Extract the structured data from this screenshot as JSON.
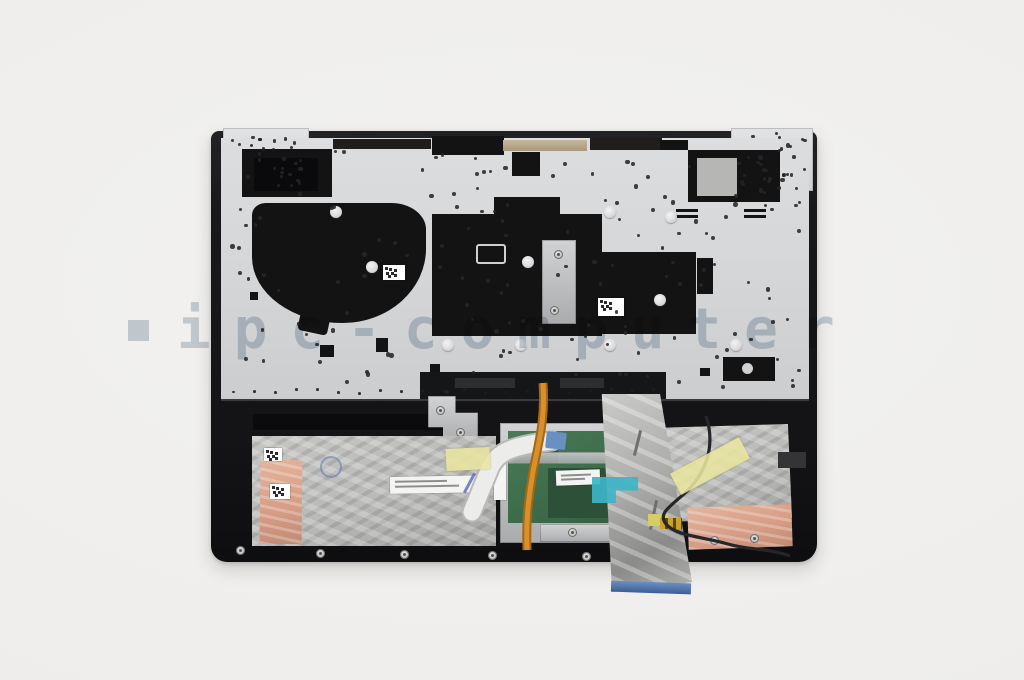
{
  "watermark": {
    "bullet_glyph": "■",
    "text": "ipc-computer",
    "color": "#c7d1d9"
  },
  "photo": {
    "colors": {
      "background": "#f2f1ef",
      "backplate": "#d6d7d9",
      "case": "#19191b",
      "mylar": "#131313",
      "foil": "#b9b9b7",
      "copper_tape": "#d69c85",
      "kapton_tape": "#e9e6a0",
      "touchpad_pcb": "#3c6a49",
      "ffc_ribbon": "#b0b0ae",
      "ribbon_tip": "#6a8fc2",
      "teal_tape": "#3db4c6",
      "backlight_cable": "#d8902f",
      "antenna_wire": "#26262a",
      "touchpad_ffc": "#ececea"
    }
  }
}
